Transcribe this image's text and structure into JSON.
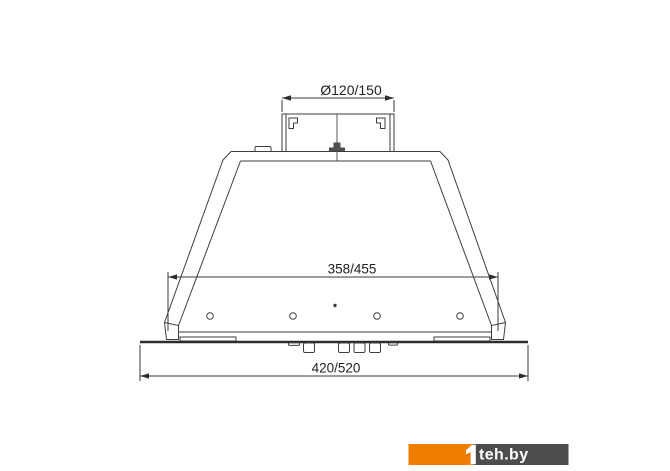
{
  "title": "cooker-hood-dimension-drawing",
  "drawing": {
    "dim_duct": "Ø120/150",
    "dim_inner_width": "358/455",
    "dim_overall_width": "420/520"
  },
  "watermark": {
    "logo_mark": "1",
    "site": "teh.by",
    "orange": "#f07c00",
    "dark": "#4d4d4d"
  }
}
